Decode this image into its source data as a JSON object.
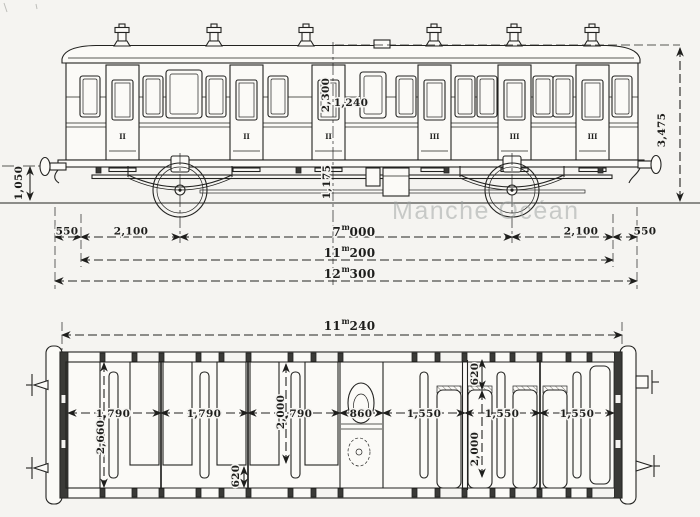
{
  "watermark": "Manche Océan",
  "side_elevation": {
    "door_class_marks": [
      "II",
      "II",
      "II",
      "III",
      "III",
      "III"
    ],
    "heights": {
      "door": "2,300",
      "bay_width": "1,240",
      "buffer": "1,050",
      "underframe": "1,175",
      "overall": "3,475"
    },
    "length_chain": {
      "buffer_left": "550",
      "overhang_left": "2,100",
      "wheelbase": {
        "whole": "7",
        "sup": "m",
        "frac": "000"
      },
      "overhang_right": "2,100",
      "buffer_right": "550"
    },
    "body_length": {
      "whole": "11",
      "sup": "m",
      "frac": "200"
    },
    "overall_length": {
      "whole": "12",
      "sup": "m",
      "frac": "300"
    }
  },
  "plan_view": {
    "overall_length": {
      "whole": "11",
      "sup": "m",
      "frac": "240"
    },
    "interior_width": "2,660",
    "compartment_widths": [
      "1,790",
      "1,790",
      "1,790",
      "860",
      "1,550",
      "1,550",
      "1,550"
    ],
    "aisle_depths": [
      "620",
      "620"
    ],
    "seat_lengths": [
      "2,000",
      "2,000"
    ]
  }
}
